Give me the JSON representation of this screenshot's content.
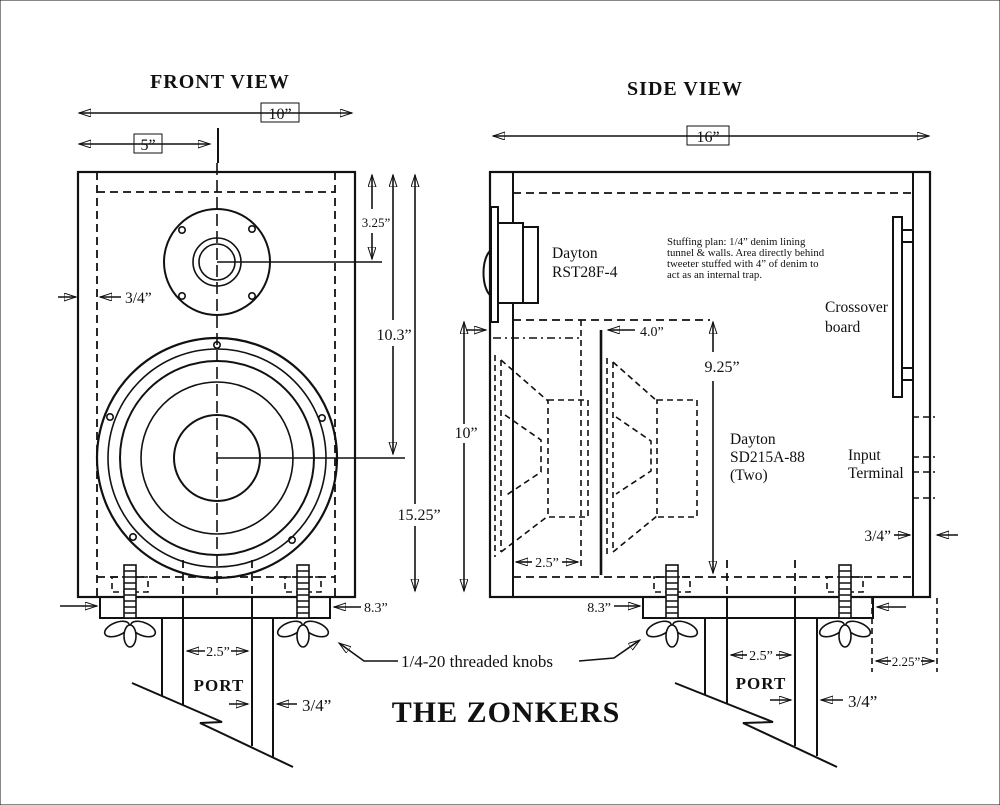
{
  "drawing": {
    "title": "THE ZONKERS",
    "knob_note": "1/4-20 threaded knobs"
  },
  "front_view": {
    "title": "FRONT VIEW",
    "dim_width": "10”",
    "dim_half_width": "5”",
    "dim_wall": "3/4”",
    "dim_tweeter_center": "3.25”",
    "dim_woofer_center": "10.3”",
    "dim_height": "15.25”",
    "dim_base_depth": "8.3”",
    "dim_port_width": "2.5”",
    "dim_port_wall": "3/4”",
    "port_label": "PORT"
  },
  "side_view": {
    "title": "SIDE VIEW",
    "dim_depth": "16”",
    "dim_front_height": "10”",
    "dim_tunnel": "4.0”",
    "dim_internal_height": "9.25”",
    "dim_magnet_gap": "2.5”",
    "dim_back_wall": "3/4”",
    "dim_base_depth": "8.3”",
    "dim_port_width": "2.5”",
    "dim_port_wall": "3/4”",
    "dim_terminal_offset": "2.25”",
    "port_label": "PORT",
    "tweeter_label_line1": "Dayton",
    "tweeter_label_line2": "RST28F-4",
    "woofer_label_line1": "Dayton",
    "woofer_label_line2": "SD215A-88",
    "woofer_label_line3": "(Two)",
    "crossover_label_line1": "Crossover",
    "crossover_label_line2": "board",
    "input_label_line1": "Input",
    "input_label_line2": "Terminal",
    "stuffing_note_line1": "Stuffing plan:  1/4” denim lining",
    "stuffing_note_line2": "tunnel & walls.  Area directly behind",
    "stuffing_note_line3": "tweeter stuffed with 4” of denim to",
    "stuffing_note_line4": "act as an internal trap."
  }
}
